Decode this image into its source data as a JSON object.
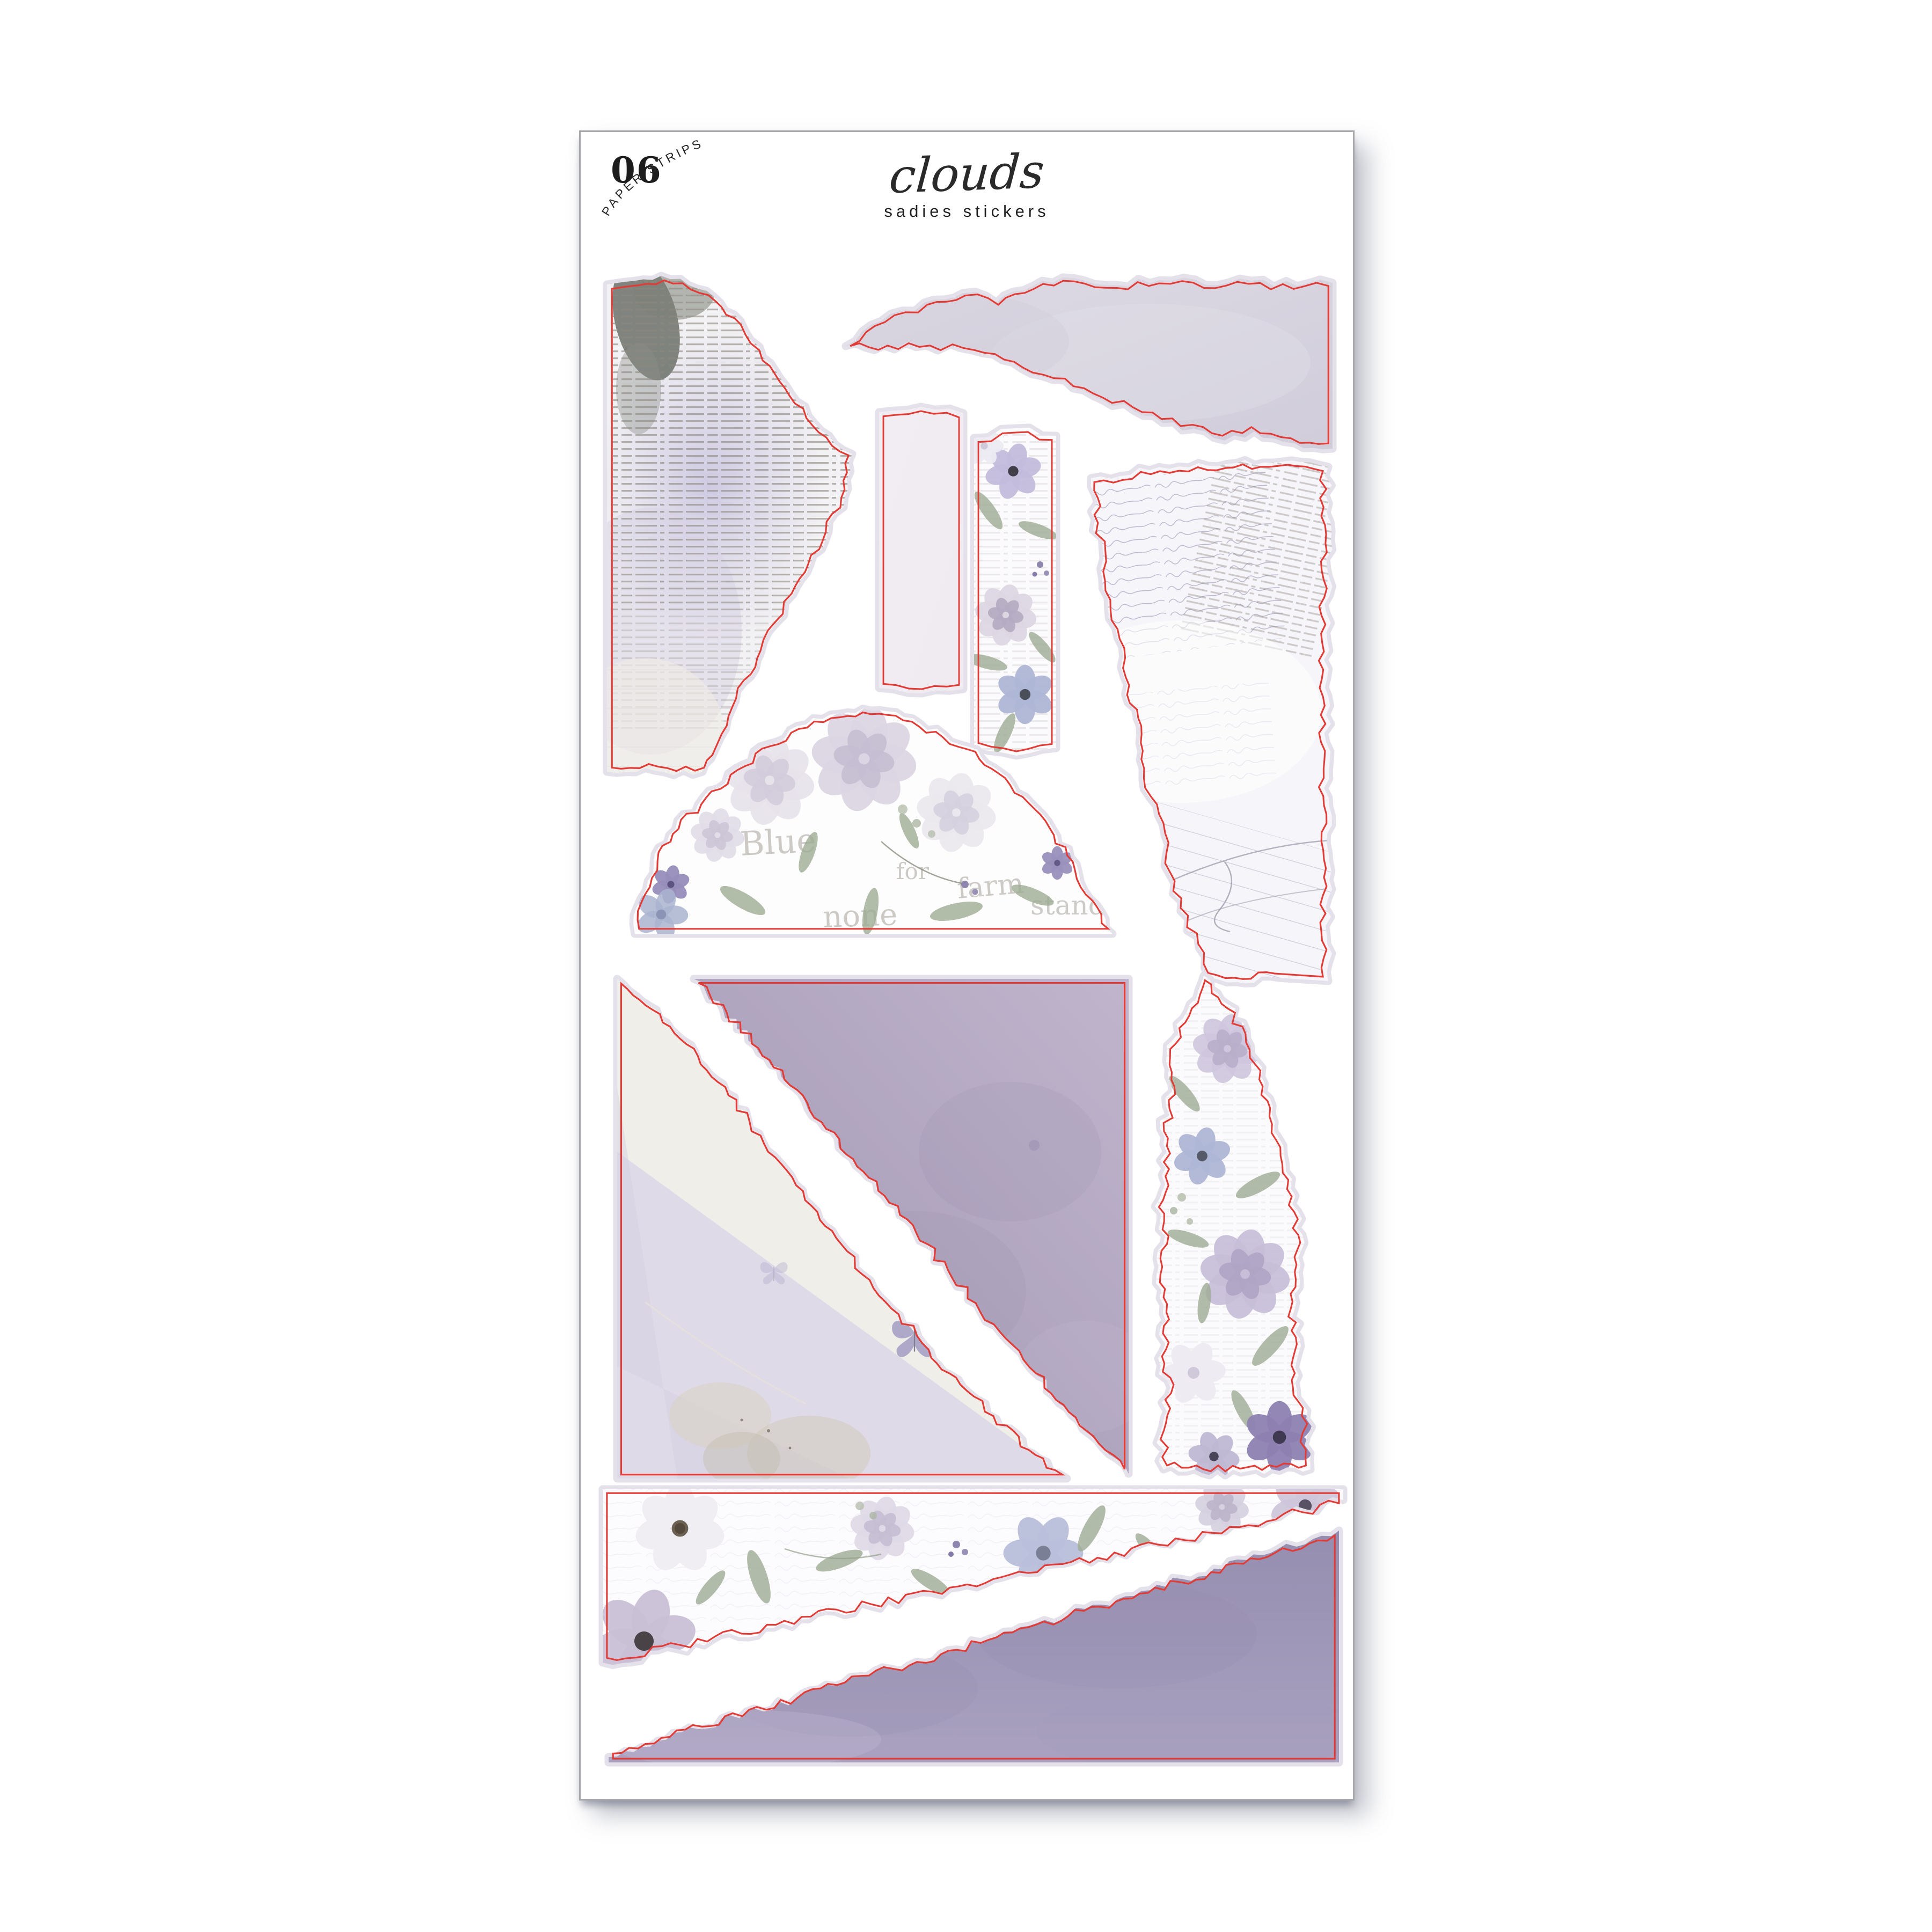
{
  "product": {
    "sheet_number": "06",
    "sheet_type_label": "PAPER STRIPS",
    "collection_title": "clouds",
    "brand": "sadies stickers"
  },
  "colors": {
    "cut_line": "#e23b36",
    "backing_halo": "#e4e1ea",
    "sheet_border": "#a7a7ac",
    "paper_white": "#fbfafc",
    "newsprint_bg": "#f2f1f3",
    "newsprint_ink": "#8d887f",
    "gray_strip": "#d7d4df",
    "blank_strip": "#f7f3f6",
    "script_paper": "#f6f5f9",
    "script_ink": "#a5a1c0",
    "lavender_wash": "#c6c1de",
    "lavender_light": "#dcd8e8",
    "purple_watercolor_dark": "#9a93b4",
    "purple_watercolor_light": "#b3a7c2",
    "sage_leaf": "#9dab93",
    "floral_purple": "#8d81b2",
    "floral_blue": "#aeb6d6",
    "ghost_type": "#a7a29a",
    "ink_text": "#1c1c1c"
  },
  "stickers": [
    {
      "name": "torn-newsprint-cloud",
      "description": "large torn vintage newsprint piece with lavender watercolor wash and dark smudge"
    },
    {
      "name": "torn-gray-watercolor-strip",
      "description": "wide torn gray-lavender watercolor strip, straight right edge"
    },
    {
      "name": "blank-paper-strip",
      "description": "plain blush-white rectangular paper strip"
    },
    {
      "name": "floral-paper-strip",
      "description": "narrow strip printed with watercolor anemones, roses and sage leaves"
    },
    {
      "name": "torn-script-ephemera",
      "description": "torn vintage ephemera paper with faint handwriting, typed text and ledger lines"
    },
    {
      "name": "floral-arch",
      "description": "arch shaped torn piece with pale roses and ghost typography",
      "ghost_words": [
        "Blue",
        "for",
        "farm",
        "stands",
        "none"
      ]
    },
    {
      "name": "textured-triangle",
      "description": "corner triangle with plaster texture, butterfly print and lavender wash"
    },
    {
      "name": "purple-watercolor-triangle",
      "description": "solid purple watercolor triangle with torn diagonal"
    },
    {
      "name": "tall-floral-strip",
      "description": "tall torn strip of watercolor roses, anemones and eucalyptus"
    },
    {
      "name": "floral-diagonal-piece",
      "description": "wide floral piece torn on the diagonal, straight top edge"
    },
    {
      "name": "purple-diagonal-piece",
      "description": "wide purple watercolor piece torn on the diagonal, straight bottom edge"
    }
  ]
}
